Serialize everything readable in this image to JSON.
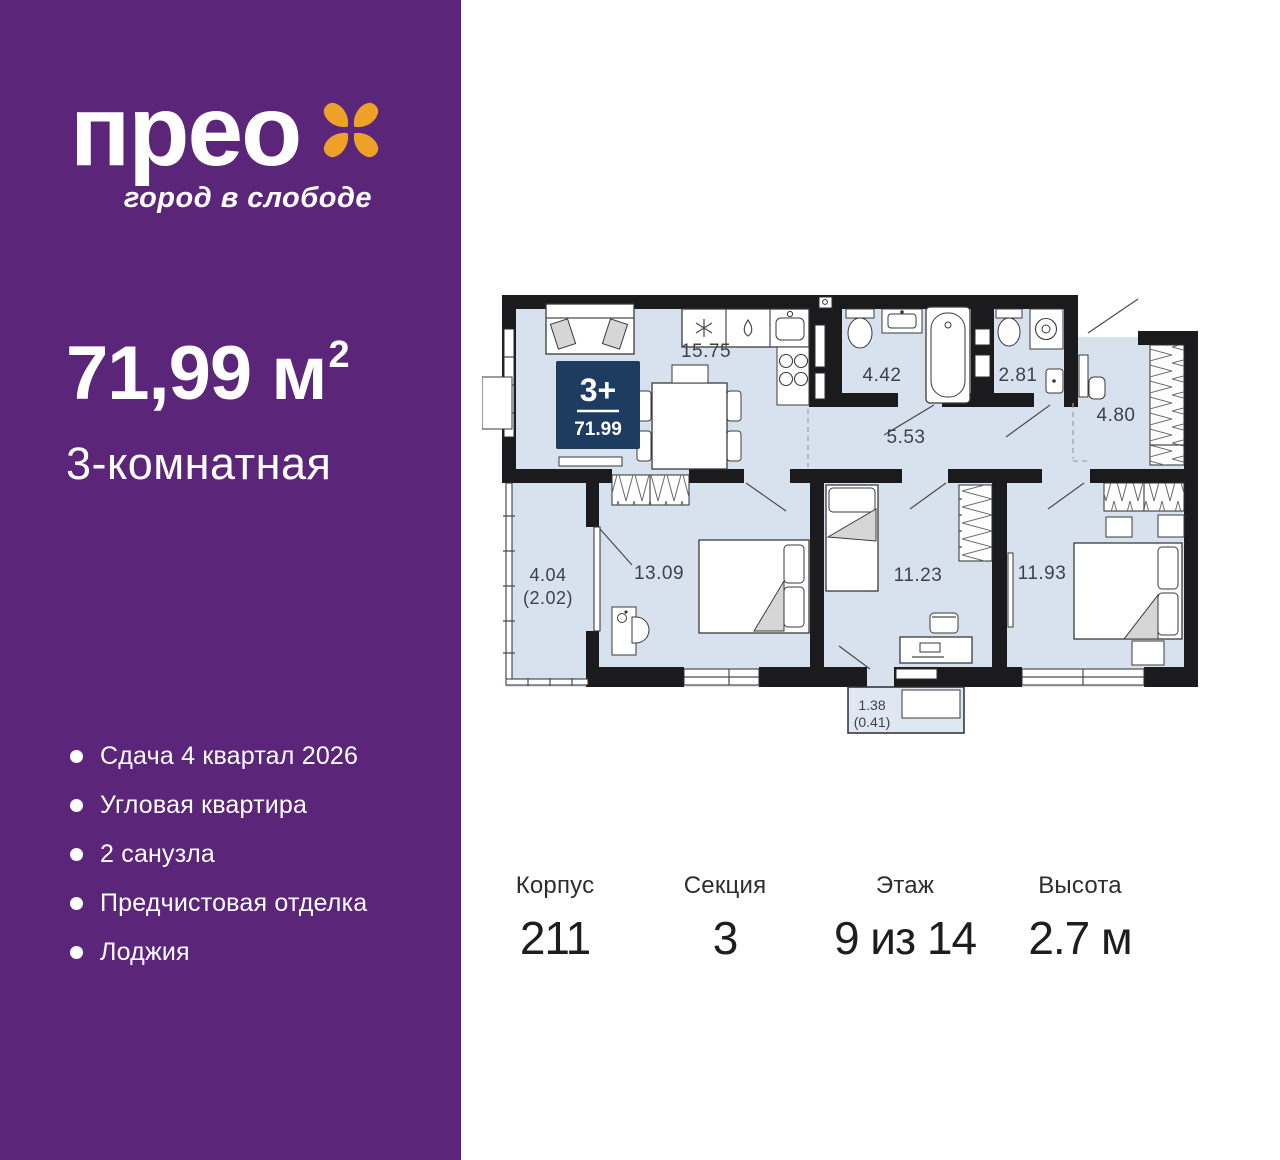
{
  "colors": {
    "sidebar_purple": "#5b2579",
    "logo_orange": "#eda227",
    "badge_navy": "#1d3c5f",
    "plan_floor": "#d8e2ef",
    "wall_black": "#1b1b1d"
  },
  "brand": {
    "logo_text": "прео",
    "flower_icon": "four-petal-flower",
    "tagline": "город в слободе"
  },
  "sidebar": {
    "area": "71,99 м",
    "area_sup": "2",
    "type": "3-комнатная",
    "features": [
      "Сдача 4 квартал 2026",
      "Угловая квартира",
      "2 санузла",
      "Предчистовая отделка",
      "Лоджия"
    ]
  },
  "plan": {
    "badge": {
      "rooms": "3+",
      "area": "71.99"
    },
    "rooms": {
      "kitchen_living": "15.75",
      "bathroom": "4.42",
      "toilet": "2.81",
      "entry": "4.80",
      "hallway": "5.53",
      "bedroom1": "13.09",
      "loggia": "4.04",
      "loggia_reduced": "(2.02)",
      "bedroom2": "11.23",
      "bedroom3": "11.93",
      "balcony": "1.38",
      "balcony_reduced": "(0.41)"
    }
  },
  "stats": [
    {
      "label": "Корпус",
      "value": "211"
    },
    {
      "label": "Секция",
      "value": "3"
    },
    {
      "label": "Этаж",
      "value": "9 из 14"
    },
    {
      "label": "Высота",
      "value": "2.7 м"
    }
  ]
}
